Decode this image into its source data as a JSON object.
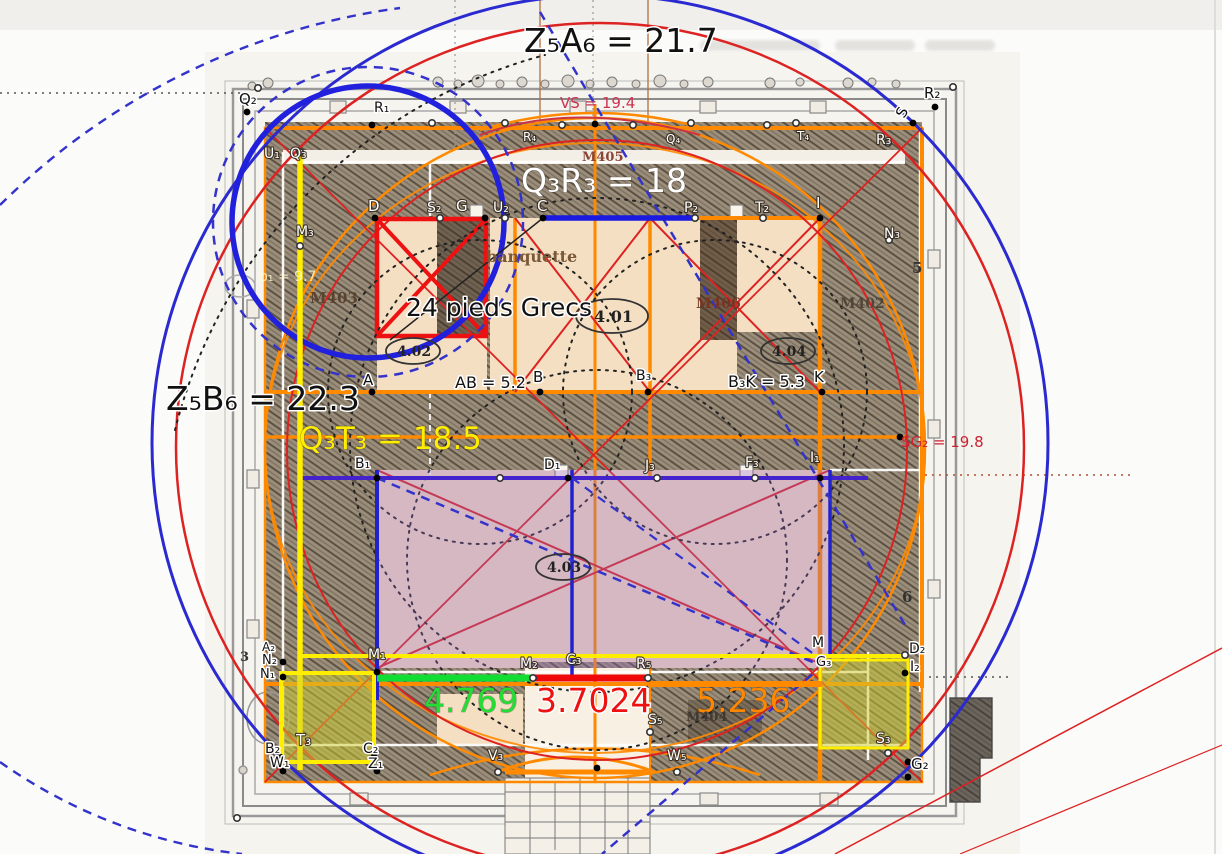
{
  "palette": {
    "big_blue": "#2a2ad0",
    "bold_blue": "#2020dd",
    "dashed_blue": "#3333cc",
    "red": "#dd2222",
    "bright_red": "#ee0808",
    "orange": "#ff8a00",
    "yellow": "#ffee00",
    "green": "#11dd33",
    "purple_line": "#4422cc",
    "purple_fill": "rgba(150,105,195,0.33)",
    "olive_fill": "rgba(205,205,45,0.5)",
    "beige": "#f5dfc2",
    "wall_gray": "#8a8a8a",
    "scan_bg": "#f6f4ef"
  },
  "labels": {
    "big": [
      {
        "t": "Z₅A₆ = 21.7",
        "x": 524,
        "y": 52,
        "c": "#111111",
        "s": 33,
        "halo": "w"
      },
      {
        "t": "Q₃R₃ = 18",
        "x": 521,
        "y": 192,
        "c": "#ffffff",
        "s": 33,
        "halo": "n"
      },
      {
        "t": "Z₅B₆ = 22.3",
        "x": 166,
        "y": 410,
        "c": "#111111",
        "s": 33,
        "halo": "w"
      },
      {
        "t": "Q₃T₃ = 18.5",
        "x": 299,
        "y": 449,
        "c": "#ffee00",
        "s": 31,
        "halo": "n"
      },
      {
        "t": "24 pieds Grecs",
        "x": 406,
        "y": 316,
        "c": "#111111",
        "s": 25,
        "halo": "w"
      },
      {
        "t": "4.769",
        "x": 424,
        "y": 712,
        "c": "#22dd33",
        "s": 33,
        "halo": "n"
      },
      {
        "t": "3.7024",
        "x": 536,
        "y": 712,
        "c": "#ee1111",
        "s": 33,
        "halo": "w"
      },
      {
        "t": "5.236",
        "x": 696,
        "y": 712,
        "c": "#ff8800",
        "s": 33,
        "halo": "n"
      }
    ],
    "small": [
      {
        "t": "VS = 19.4",
        "x": 560,
        "y": 108,
        "c": "#cc3352",
        "s": 15
      },
      {
        "t": "SG₂ = 19.8",
        "x": 901,
        "y": 447,
        "c": "#cc2233",
        "s": 15
      },
      {
        "t": "AB = 5.2",
        "x": 455,
        "y": 388,
        "c": "#111111",
        "s": 16,
        "halo": "w"
      },
      {
        "t": "B₃K = 5.3",
        "x": 728,
        "y": 387,
        "c": "#111111",
        "s": 16,
        "halo": "w"
      },
      {
        "t": "b₁ = 9.7",
        "x": 259,
        "y": 281,
        "c": "rgba(255,250,205,0.85)",
        "s": 14
      }
    ],
    "points_white": [
      {
        "t": "U₁",
        "x": 264,
        "y": 158
      },
      {
        "t": "Q₃",
        "x": 290,
        "y": 158
      },
      {
        "t": "M₃",
        "x": 296,
        "y": 236
      },
      {
        "t": "R₄",
        "x": 523,
        "y": 141,
        "s": 12
      },
      {
        "t": "Q₄",
        "x": 666,
        "y": 143,
        "s": 12
      },
      {
        "t": "T₄",
        "x": 797,
        "y": 140,
        "s": 12
      },
      {
        "t": "D",
        "x": 368,
        "y": 211,
        "s": 15
      },
      {
        "t": "S₂",
        "x": 427,
        "y": 212
      },
      {
        "t": "G",
        "x": 456,
        "y": 211,
        "s": 15
      },
      {
        "t": "U₂",
        "x": 493,
        "y": 212
      },
      {
        "t": "C",
        "x": 537,
        "y": 211,
        "s": 15
      },
      {
        "t": "P₂",
        "x": 684,
        "y": 212
      },
      {
        "t": "T₂",
        "x": 755,
        "y": 212
      },
      {
        "t": "I",
        "x": 816,
        "y": 208,
        "s": 15
      },
      {
        "t": "R₃",
        "x": 876,
        "y": 144
      },
      {
        "t": "N₃",
        "x": 884,
        "y": 238
      },
      {
        "t": "J₃",
        "x": 645,
        "y": 470
      },
      {
        "t": "F₃",
        "x": 745,
        "y": 467
      },
      {
        "t": "I₁",
        "x": 810,
        "y": 462
      },
      {
        "t": "M₁",
        "x": 368,
        "y": 659
      },
      {
        "t": "M₂",
        "x": 520,
        "y": 668
      },
      {
        "t": "C₃",
        "x": 566,
        "y": 664
      },
      {
        "t": "R₅",
        "x": 636,
        "y": 668
      },
      {
        "t": "S₅",
        "x": 648,
        "y": 724
      },
      {
        "t": "V₃",
        "x": 488,
        "y": 760
      },
      {
        "t": "W₅",
        "x": 667,
        "y": 760
      },
      {
        "t": "T₃",
        "x": 296,
        "y": 745,
        "s": 15
      },
      {
        "t": "S₃",
        "x": 876,
        "y": 743
      }
    ],
    "points_black": [
      {
        "t": "Q₂",
        "x": 239,
        "y": 104,
        "s": 15
      },
      {
        "t": "R₁",
        "x": 374,
        "y": 112
      },
      {
        "t": "S",
        "x": 904,
        "y": 119,
        "s": 15,
        "rot": -60
      },
      {
        "t": "R₂",
        "x": 924,
        "y": 98,
        "s": 15
      },
      {
        "t": "A₂",
        "x": 262,
        "y": 651,
        "s": 12
      },
      {
        "t": "N₂",
        "x": 262,
        "y": 664,
        "s": 13
      },
      {
        "t": "N₁",
        "x": 260,
        "y": 678,
        "s": 13
      },
      {
        "t": "A",
        "x": 363,
        "y": 385,
        "s": 15
      },
      {
        "t": "B",
        "x": 533,
        "y": 382,
        "s": 15
      },
      {
        "t": "B₃",
        "x": 636,
        "y": 380
      },
      {
        "t": "K",
        "x": 814,
        "y": 382,
        "s": 15
      },
      {
        "t": "B₁",
        "x": 355,
        "y": 468
      },
      {
        "t": "D₁",
        "x": 544,
        "y": 469
      },
      {
        "t": "D₂",
        "x": 909,
        "y": 653
      },
      {
        "t": "I₂",
        "x": 910,
        "y": 671
      },
      {
        "t": "M",
        "x": 812,
        "y": 647
      },
      {
        "t": "G₃",
        "x": 816,
        "y": 666,
        "s": 13
      },
      {
        "t": "B₂",
        "x": 265,
        "y": 753
      },
      {
        "t": "W₁",
        "x": 270,
        "y": 767
      },
      {
        "t": "C₂",
        "x": 363,
        "y": 753
      },
      {
        "t": "Z₁",
        "x": 368,
        "y": 768
      },
      {
        "t": "G₂",
        "x": 911,
        "y": 769,
        "s": 15
      }
    ],
    "plan": [
      {
        "t": "M403",
        "x": 310,
        "y": 303,
        "c": "#5a4430",
        "s": 15
      },
      {
        "t": "M405",
        "x": 582,
        "y": 161,
        "c": "#8a4436",
        "s": 13
      },
      {
        "t": "M406",
        "x": 696,
        "y": 308,
        "c": "#7a3322",
        "s": 14
      },
      {
        "t": "M402",
        "x": 840,
        "y": 308,
        "c": "#514738",
        "s": 14
      },
      {
        "t": "M404",
        "x": 686,
        "y": 721,
        "c": "#3f3a33",
        "s": 13
      },
      {
        "t": "banquette",
        "x": 486,
        "y": 262,
        "c": "#7a5838",
        "s": 16
      },
      {
        "t": "4.01",
        "x": 594,
        "y": 322,
        "c": "#222222",
        "s": 16
      },
      {
        "t": "4.02",
        "x": 397,
        "y": 356,
        "c": "#222222",
        "s": 14
      },
      {
        "t": "4.04",
        "x": 772,
        "y": 356,
        "c": "#222222",
        "s": 14
      },
      {
        "t": "4.03",
        "x": 547,
        "y": 572,
        "c": "#222222",
        "s": 14
      },
      {
        "t": "5",
        "x": 912,
        "y": 273,
        "c": "#333333",
        "s": 15
      },
      {
        "t": "6",
        "x": 902,
        "y": 602,
        "c": "#333333",
        "s": 15
      },
      {
        "t": "3",
        "x": 240,
        "y": 661,
        "c": "#333333",
        "s": 13
      }
    ]
  },
  "plan_ellipses": [
    [
      612,
      316,
      36,
      17
    ],
    [
      413,
      351,
      27,
      13
    ],
    [
      788,
      351,
      27,
      13
    ],
    [
      563,
      567,
      27,
      13
    ]
  ],
  "markers": {
    "filled": [
      [
        247,
        112
      ],
      [
        372,
        125
      ],
      [
        595,
        124
      ],
      [
        935,
        107
      ],
      [
        913,
        123
      ],
      [
        375,
        218
      ],
      [
        485,
        218
      ],
      [
        543,
        218
      ],
      [
        820,
        218
      ],
      [
        372,
        392
      ],
      [
        540,
        392
      ],
      [
        648,
        392
      ],
      [
        822,
        392
      ],
      [
        900,
        437
      ],
      [
        377,
        478
      ],
      [
        568,
        478
      ],
      [
        820,
        478
      ],
      [
        283,
        662
      ],
      [
        283,
        677
      ],
      [
        377,
        672
      ],
      [
        820,
        663
      ],
      [
        905,
        673
      ],
      [
        280,
        757
      ],
      [
        283,
        771
      ],
      [
        374,
        757
      ],
      [
        377,
        771
      ],
      [
        908,
        762
      ],
      [
        908,
        777
      ],
      [
        597,
        768
      ]
    ],
    "open": [
      [
        258,
        88
      ],
      [
        953,
        87
      ],
      [
        300,
        152
      ],
      [
        300,
        246
      ],
      [
        432,
        123
      ],
      [
        505,
        123
      ],
      [
        562,
        125
      ],
      [
        633,
        125
      ],
      [
        691,
        123
      ],
      [
        767,
        125
      ],
      [
        796,
        123
      ],
      [
        888,
        143
      ],
      [
        889,
        240
      ],
      [
        440,
        218
      ],
      [
        505,
        218
      ],
      [
        695,
        218
      ],
      [
        763,
        218
      ],
      [
        500,
        478
      ],
      [
        657,
        478
      ],
      [
        755,
        478
      ],
      [
        533,
        678
      ],
      [
        648,
        678
      ],
      [
        575,
        662
      ],
      [
        905,
        655
      ],
      [
        888,
        753
      ],
      [
        498,
        772
      ],
      [
        677,
        772
      ],
      [
        650,
        732
      ],
      [
        237,
        818
      ]
    ]
  }
}
